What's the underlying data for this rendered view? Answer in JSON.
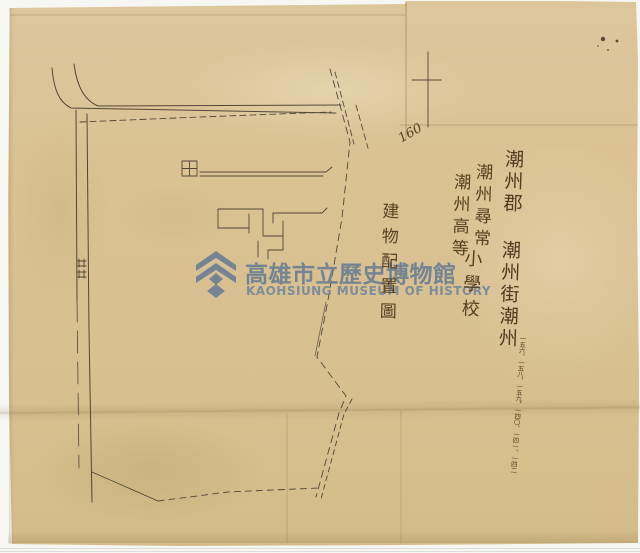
{
  "document": {
    "kind": "scanned archival site-plan",
    "paper_color": "#d9c293",
    "background_color": "#f6f6f3",
    "ink_color": "#42362a"
  },
  "watermark": {
    "logo": "kaohsiung-museum-logo",
    "title": "高雄市立歷史博物館",
    "subtitle": "KAOHSIUNG MUSEUM OF HISTORY",
    "color": "#5e7692"
  },
  "handwriting": {
    "ink_color": "#57401f",
    "ref_number": "160",
    "drawing_title": "建物配置圖",
    "address_column": "潮州郡 潮州街潮州",
    "school_column_right": "潮州尋常",
    "school_column_left": "潮州高等",
    "school_column_suffix": "小學校",
    "lot_numbers": "一五六、一五八、一五九、一四〇、一四一、一四二"
  },
  "map": {
    "field_symbol": "田"
  }
}
